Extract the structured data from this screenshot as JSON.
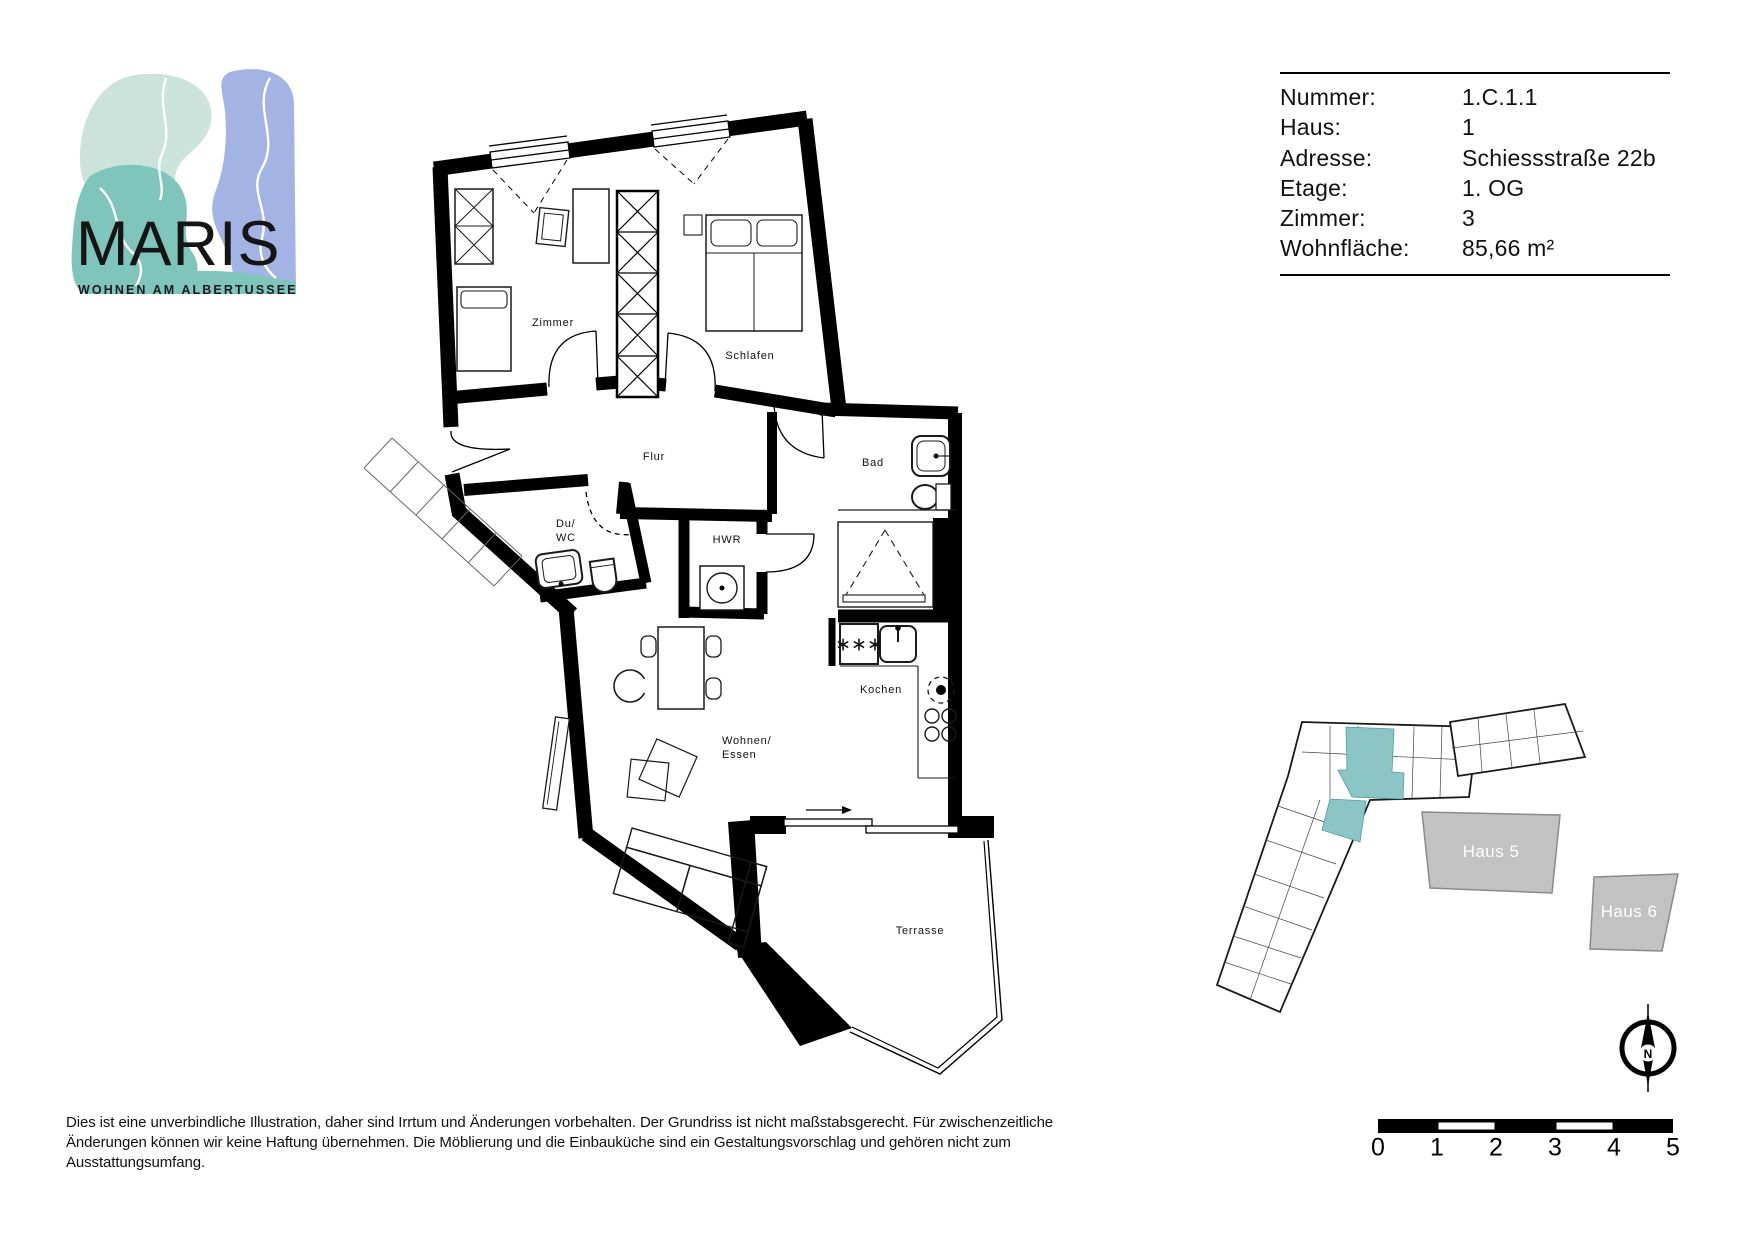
{
  "logo": {
    "brand": "MARIS",
    "tagline": "WOHNEN AM ALBERTUSSEE",
    "colors": {
      "mint": "#CBE3DB",
      "teal": "#7FC5BC",
      "blue": "#A3B4E4"
    }
  },
  "info_table": {
    "rows": [
      {
        "label": "Nummer:",
        "value": "1.C.1.1"
      },
      {
        "label": "Haus:",
        "value": "1"
      },
      {
        "label": "Adresse:",
        "value": "Schiessstraße 22b"
      },
      {
        "label": "Etage:",
        "value": "1. OG"
      },
      {
        "label": "Zimmer:",
        "value": "3"
      },
      {
        "label": "Wohnfläche:",
        "value": "85,66 m²"
      }
    ]
  },
  "floor_plan": {
    "rooms": [
      {
        "label": "Zimmer"
      },
      {
        "label": "Schlafen"
      },
      {
        "label": "Flur"
      },
      {
        "label": "Bad"
      },
      {
        "label": "Du/\nWC"
      },
      {
        "label": "HWR"
      },
      {
        "label": "Kochen"
      },
      {
        "label": "Wohnen/\nEssen"
      },
      {
        "label": "Terrasse"
      }
    ],
    "freezer_symbol": "∗∗∗"
  },
  "site_plan": {
    "blocks": [
      {
        "label": "Haus 5"
      },
      {
        "label": "Haus 6"
      }
    ],
    "highlight_color": "#8CC5C5",
    "compass_label": "N"
  },
  "scale_bar": {
    "ticks": [
      "0",
      "1",
      "2",
      "3",
      "4",
      "5"
    ]
  },
  "disclaimer": {
    "text": "Dies ist eine unverbindliche Illustration, daher sind Irrtum und Änderungen vorbehalten. Der Grundriss ist nicht maßstabsgerecht. Für zwischenzeitliche\nÄnderungen können wir keine Haftung übernehmen. Die Möblierung und die Einbauküche sind ein Gestaltungsvorschlag und gehören nicht zum Ausstattungsumfang."
  }
}
